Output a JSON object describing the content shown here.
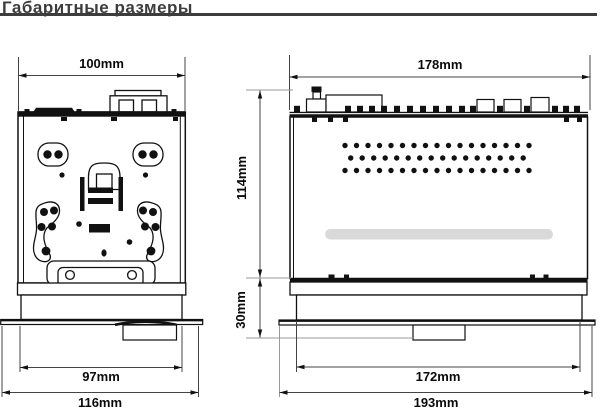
{
  "title": "Габаритные размеры",
  "drawings": {
    "top_view": {
      "dims": {
        "top_width": "100mm",
        "inner_width": "97mm",
        "outer_width": "116mm"
      }
    },
    "side_view": {
      "dims": {
        "top_width": "178mm",
        "body_height": "114mm",
        "base_height": "30mm",
        "inner_width": "172mm",
        "outer_width": "193mm"
      }
    }
  },
  "colors": {
    "background": "#ffffff",
    "outline": "#111111",
    "dim_line": "#444444",
    "leader_line": "#999999",
    "title_text": "#3d3d3d",
    "slot_gray": "#d9d9d9"
  }
}
